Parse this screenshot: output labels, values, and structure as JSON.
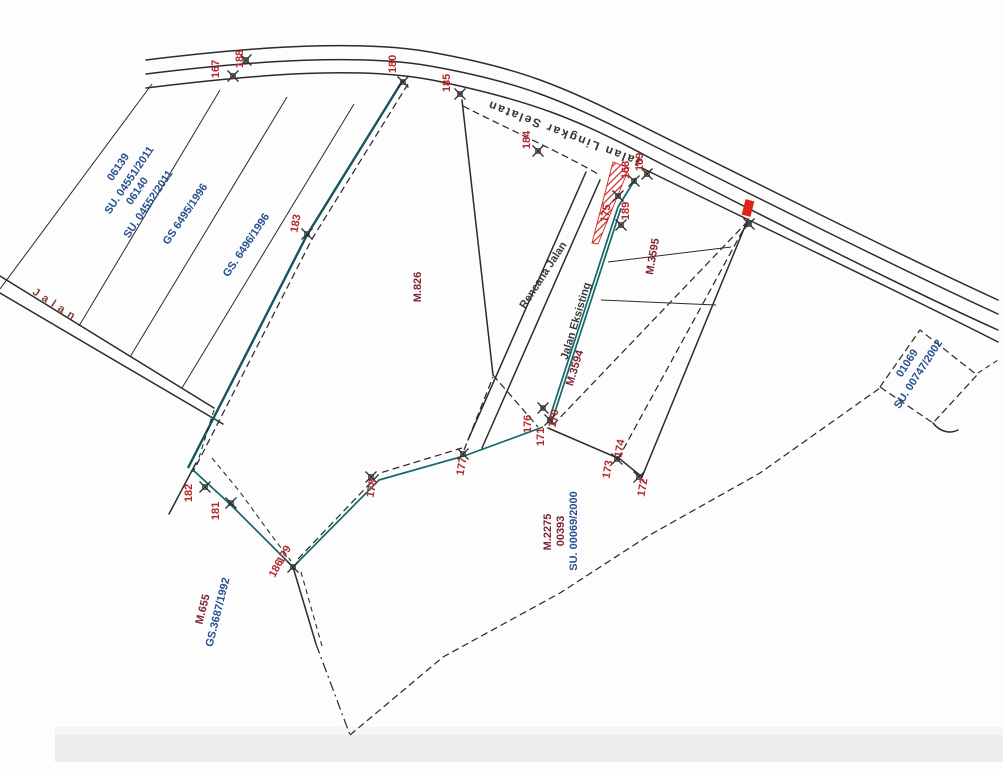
{
  "map": {
    "roads": {
      "top_road_label": "Jalan Lingkar Selatan",
      "left_road_label": "Jalan",
      "planned_road_label": "Rencana Jalan",
      "existing_road_label": "Jalan Eksisting"
    },
    "parcels": {
      "strip1_lot": "06139",
      "strip1_su": "SU. 04551/2011",
      "strip2_lot": "06140",
      "strip2_su": "SU. 04552/2011",
      "strip3_gs": "GS 6495/1996",
      "strip4_gs": "GS. 6496/1996",
      "lot_m826": "M.826",
      "lot_m3595": "M.3595",
      "lot_m3594": "M.3594",
      "lot_01069": "01069",
      "lot_01069_su": "SU. 00747/2002",
      "lot_m2275": "M.2275",
      "lot_m2275_no": "00393",
      "lot_m2275_su": "SU. 00069/2000",
      "lot_m655": "M.655",
      "lot_m655_gs": "GS.3687/1992"
    },
    "survey_points": {
      "pt167": "167",
      "pt188": "188",
      "pt180": "180",
      "pt185": "185",
      "pt184": "184",
      "pt168": "168",
      "pt169": "169",
      "pt175": "175",
      "pt189": "189",
      "pt183": "183",
      "pt176": "176",
      "pt171": "171",
      "pt170": "170",
      "pt177": "177",
      "pt178": "178",
      "pt174": "174",
      "pt173": "173",
      "pt172": "172",
      "pt182": "182",
      "pt181": "181",
      "pt179": "179",
      "pt186": "186"
    },
    "colors": {
      "line_black": "#2b2b2b",
      "existing_road_teal": "#13686a",
      "point_number_red": "#b3282d",
      "parcel_text_maroon": "#7e2433",
      "parcel_text_navy": "#27508f",
      "hatch_red": "#cc2a22",
      "marker_red": "#e02417"
    }
  }
}
